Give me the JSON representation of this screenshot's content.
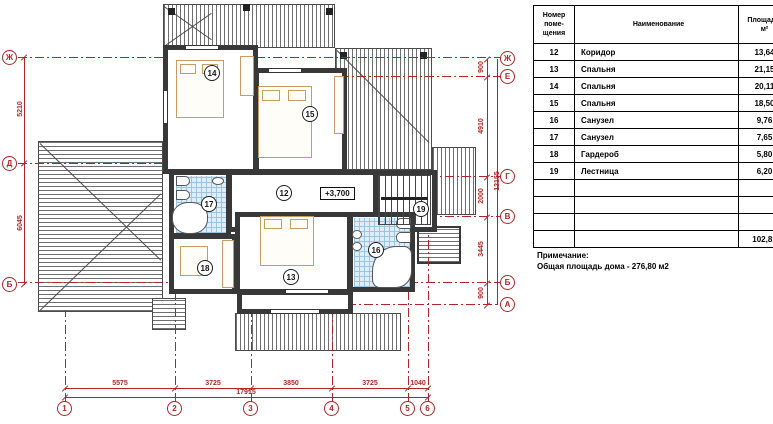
{
  "plan": {
    "elevation": "+3,700",
    "rooms": {
      "r12": "12",
      "r13": "13",
      "r14": "14",
      "r15": "15",
      "r16": "16",
      "r17": "17",
      "r18": "18",
      "r19": "19"
    },
    "axes": {
      "left": [
        "Ж",
        "Д",
        "Б"
      ],
      "right": [
        "Ж",
        "Е",
        "Г",
        "В",
        "Б",
        "А"
      ],
      "bottom": [
        "1",
        "2",
        "3",
        "4",
        "5",
        "6"
      ]
    },
    "dims": {
      "bottom": [
        "5575",
        "3725",
        "3850",
        "3725",
        "1040"
      ],
      "bottom_total": "17915",
      "left": [
        "5210",
        "6045"
      ],
      "right": [
        "900",
        "4910",
        "2000",
        "3445",
        "900"
      ],
      "right_total": "12155"
    },
    "colors": {
      "axis_red": "#b02525",
      "tile_blue": "#ddeefa",
      "furniture_tan": "#c79b62",
      "wall_dark": "#383838"
    }
  },
  "table": {
    "header": {
      "num": "Номер\nпоме-\nщения",
      "name": "Наименование",
      "area": "Площадь,\nм²"
    },
    "rows": [
      {
        "num": "12",
        "name": "Коридор",
        "area": "13,64"
      },
      {
        "num": "13",
        "name": "Спальня",
        "area": "21,15"
      },
      {
        "num": "14",
        "name": "Спальня",
        "area": "20,11"
      },
      {
        "num": "15",
        "name": "Спальня",
        "area": "18,50"
      },
      {
        "num": "16",
        "name": "Санузел",
        "area": "9,76"
      },
      {
        "num": "17",
        "name": "Санузел",
        "area": "7,65"
      },
      {
        "num": "18",
        "name": "Гардероб",
        "area": "5,80"
      },
      {
        "num": "19",
        "name": "Лестница",
        "area": "6,20"
      }
    ],
    "total": "102,81"
  },
  "note": {
    "title": "Примечание:",
    "text": "Общая площадь дома  -  276,80 м2"
  }
}
